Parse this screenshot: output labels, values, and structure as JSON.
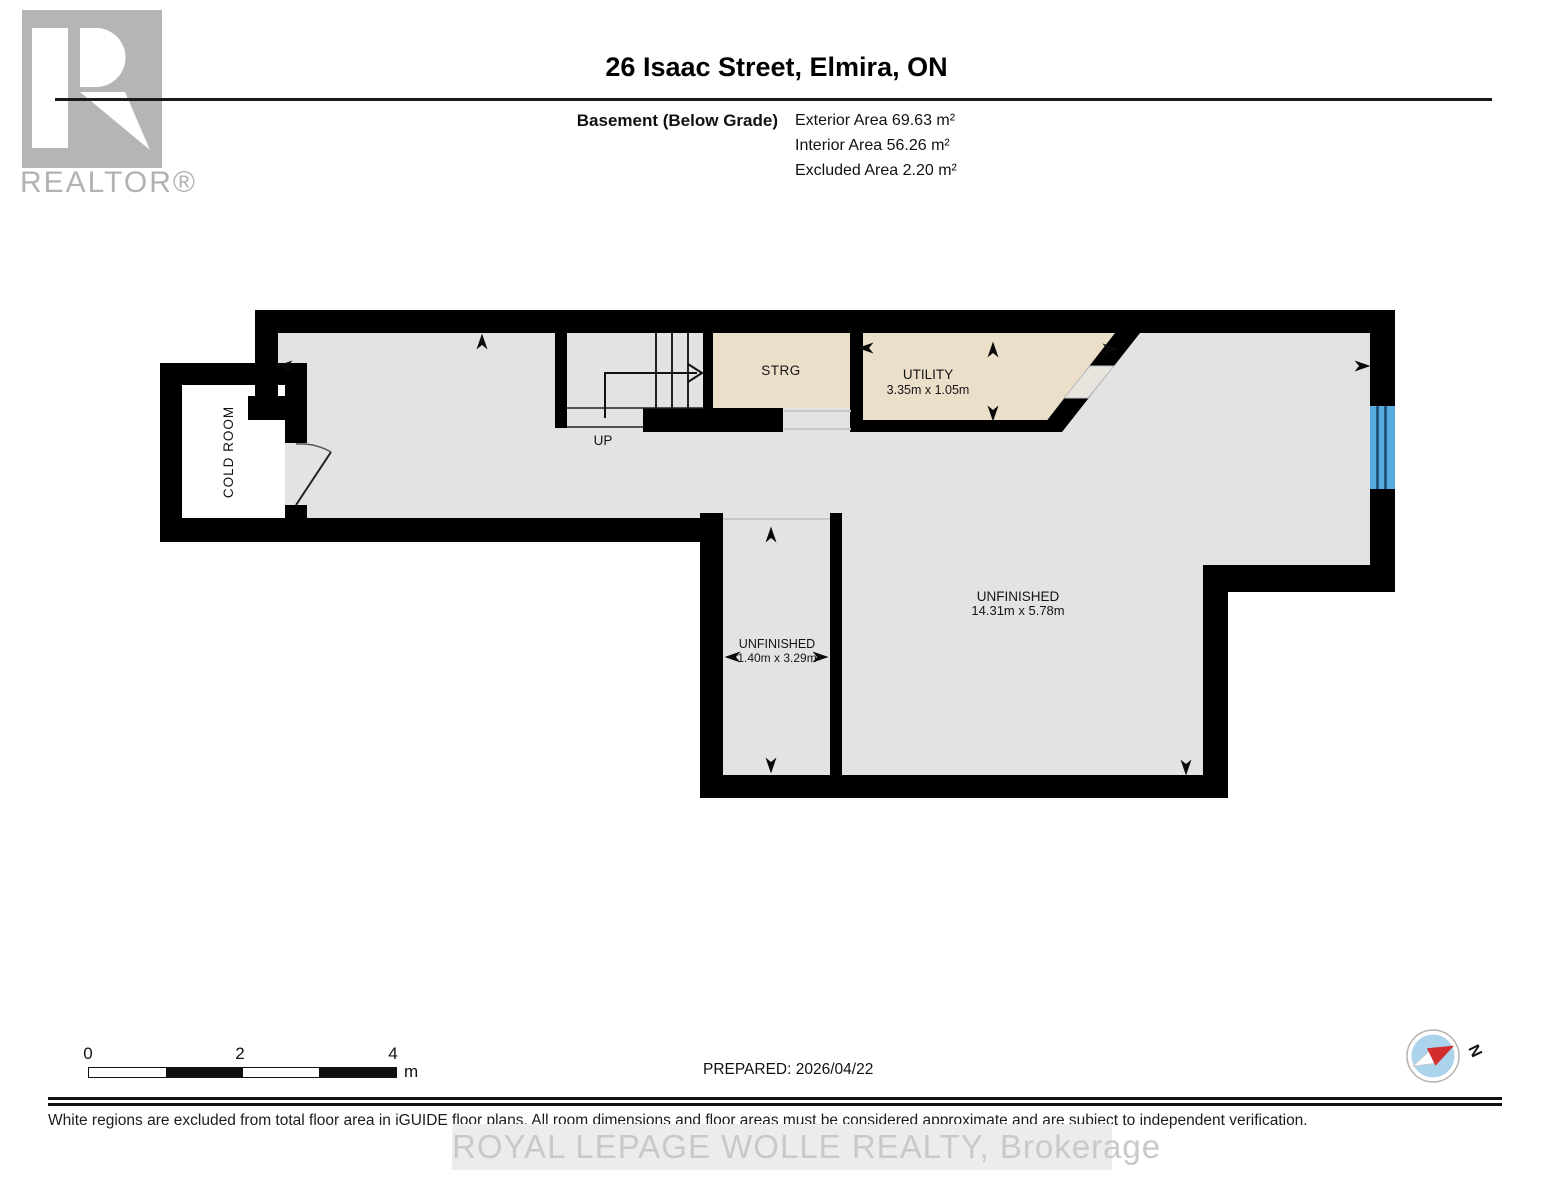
{
  "header": {
    "logo_text": "REALTOR®",
    "title": "26 Isaac Street, Elmira, ON",
    "floor_label": "Basement (Below Grade)",
    "area_lines": [
      "Exterior Area 69.63 m²",
      "Interior Area 56.26 m²",
      "Excluded Area 2.20 m²"
    ]
  },
  "plan": {
    "rooms": {
      "cold_room_label": "COLD ROOM",
      "storage_label": "STRG",
      "utility_label": "UTILITY",
      "utility_dims": "3.35m x 1.05m",
      "hall_label": "UNFINISHED",
      "hall_dims": "1.40m x 3.29m",
      "main_label": "UNFINISHED",
      "main_dims": "14.31m x 5.78m"
    },
    "stairs_label": "UP"
  },
  "scale_bar": {
    "tick0": "0",
    "tick1": "2",
    "tick2": "4",
    "unit": "m"
  },
  "compass": {
    "north_label": "N"
  },
  "footer": {
    "prepared": "PREPARED: 2026/04/22",
    "disclaimer": "White regions are excluded from total floor area in iGUIDE floor plans. All room dimensions and floor areas must be considered approximate and are subject to independent verification.",
    "watermark": "ROYAL LEPAGE WOLLE REALTY, Brokerage"
  },
  "colors": {
    "wall": "#000000",
    "floor": "#e3e3e3",
    "excluded_area": "#ffffff",
    "finished_room": "#ecdfc9",
    "window": "#57aade",
    "compass_disc": "#abd3ec",
    "compass_needle_red": "#d32d2d",
    "logo_gray": "#b5b5b5",
    "watermark_gray": "#c9c9c9"
  }
}
